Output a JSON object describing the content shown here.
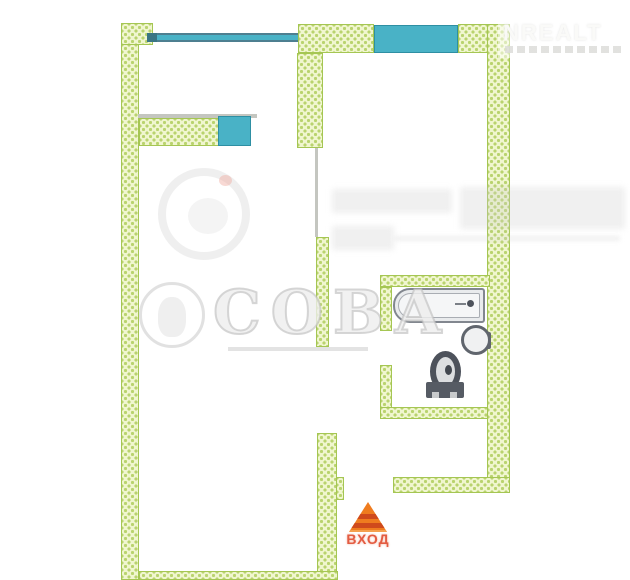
{
  "watermarks": {
    "top_right_brand": "NREALT",
    "center_brand": "СОВА"
  },
  "entrance": {
    "label": "ВХОД"
  },
  "icons": {
    "bathtub": "bathtub-icon",
    "washbasin": "washbasin-icon",
    "toilet": "toilet-icon",
    "entrance_arrow": "entrance-arrow-icon",
    "owl_logo": "owl-logo-icon",
    "round_logo": "round-logo-icon"
  },
  "colors": {
    "wall_fill": "#f0f6cf",
    "wall_dot": "#b9d36e",
    "wall_border": "#a5c653",
    "window_fill": "#49b2c6",
    "window_border": "#2e8fa3",
    "fixture_outline": "#82878f",
    "toilet_dark": "#4d525b",
    "arrow_orange": "#ef7c1f",
    "arrow_stripe": "#cf4a1c",
    "entrance_text_color": "#e14b2e",
    "background": "#ffffff"
  }
}
